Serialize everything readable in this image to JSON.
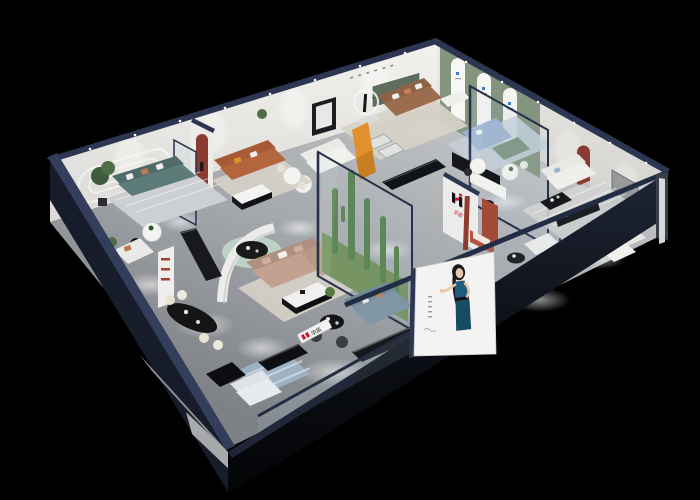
{
  "brand": {
    "name": "华凯",
    "logo_letter": "H"
  },
  "poster": {
    "subject": "woman-in-blue-dress"
  },
  "palette": {
    "background": "#000000",
    "wall_top": "#2c3650",
    "wall_face": "#edecе8",
    "wall_face_light": "#f1f0ec",
    "wall_face_shade": "#d8d7d3",
    "sage_wall": "#83957f",
    "floor_far": "#c9cbcd",
    "floor_near": "#85888d",
    "accent_arch_red": "#8a3a30",
    "brand_red": "#c8102e",
    "brand_black": "#101014",
    "teal_sofa": "#5d7b79",
    "leather_orange": "#b3663c",
    "leather_brown": "#9c6c4e",
    "sofa_tan": "#c2a191",
    "sofa_blue": "#9fb3d0",
    "sofa_slate": "#7e95a2",
    "sofa_green": "#7d937e",
    "sofa_white": "#ebebe8",
    "greenery": "#4d7a44",
    "moss": "#6b8b4f",
    "rug_beige": "#d7d2c8",
    "rug_blue": "#9db3c4",
    "rug_mint": "#bcd2c6",
    "glass_frame": "#27314a",
    "poster_bg": "#f4f3f1",
    "dress_blue": "#1d5d80",
    "skin": "#e8c6a9",
    "ottoman_teal": "#5f8086",
    "orange_accent": "#e0912e",
    "exterior_dark": "#161c29",
    "exterior_skirt": "#8d9095"
  }
}
